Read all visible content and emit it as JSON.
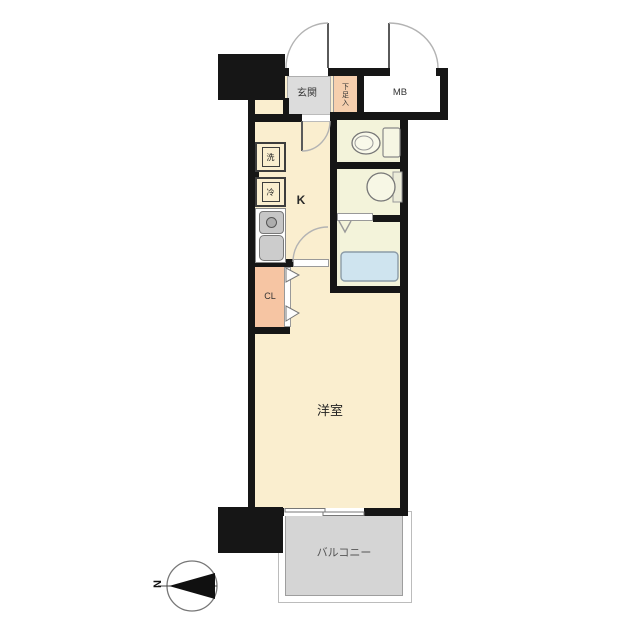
{
  "floorplan": {
    "rooms": {
      "entrance_label": "玄関",
      "shoe_box_label": "下足入",
      "meter_box_label": "MB",
      "kitchen_label": "K",
      "closet_label": "CL",
      "western_room_label": "洋室",
      "balcony_label": "バルコニー"
    },
    "fixtures": {
      "washer_label": "洗",
      "fridge_label": "冷"
    },
    "compass": {
      "north_label": "N"
    },
    "colors": {
      "wall": "#161616",
      "floor": "#faeecf",
      "entrance": "#dcdcdc",
      "shoe_box": "#f6cfae",
      "closet": "#f6c5a3",
      "wet_area": "#f3f3da",
      "bathtub": "#cfe4ef",
      "balcony": "#d5d5d5",
      "counter": "#ffffff",
      "appliance": "#c6c6c6"
    }
  }
}
